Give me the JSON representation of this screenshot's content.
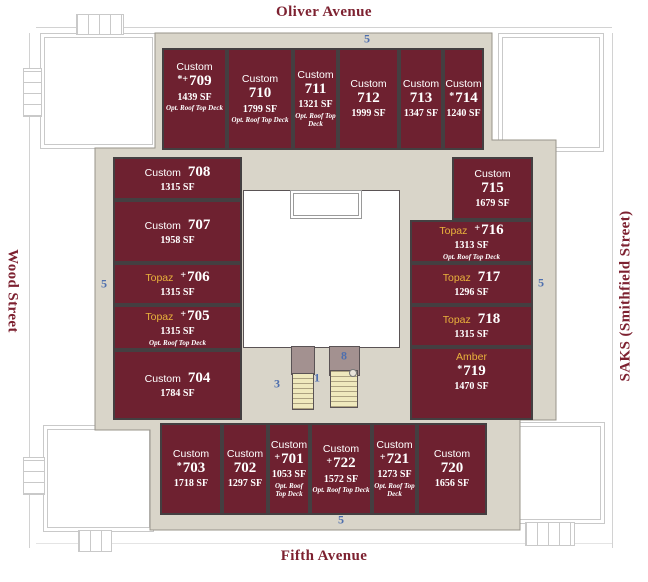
{
  "streets": {
    "top": "Oliver Avenue",
    "bottom": "Fifth Avenue",
    "left": "Wood Street",
    "right": "SAKS (Smithfield Street)"
  },
  "units": [
    {
      "id": "709",
      "brand": "Custom",
      "style": "custom",
      "prefix": "*+",
      "number": "709",
      "sf": "1439 SF",
      "note": "Opt. Roof Top Deck",
      "layout": "stacked"
    },
    {
      "id": "710",
      "brand": "Custom",
      "style": "custom",
      "prefix": "",
      "number": "710",
      "sf": "1799 SF",
      "note": "Opt. Roof Top Deck",
      "layout": "stacked"
    },
    {
      "id": "711",
      "brand": "Custom",
      "style": "custom",
      "prefix": "",
      "number": "711",
      "sf": "1321 SF",
      "note": "Opt. Roof Top Deck",
      "layout": "stacked"
    },
    {
      "id": "712",
      "brand": "Custom",
      "style": "custom",
      "prefix": "",
      "number": "712",
      "sf": "1999 SF",
      "note": "",
      "layout": "stacked"
    },
    {
      "id": "713",
      "brand": "Custom",
      "style": "custom",
      "prefix": "",
      "number": "713",
      "sf": "1347 SF",
      "note": "",
      "layout": "stacked"
    },
    {
      "id": "714",
      "brand": "Custom",
      "style": "custom",
      "prefix": "*",
      "number": "714",
      "sf": "1240 SF",
      "note": "",
      "layout": "stacked"
    },
    {
      "id": "708",
      "brand": "Custom",
      "style": "custom",
      "prefix": "",
      "number": "708",
      "sf": "1315 SF",
      "note": "",
      "layout": "inline"
    },
    {
      "id": "707",
      "brand": "Custom",
      "style": "custom",
      "prefix": "",
      "number": "707",
      "sf": "1958 SF",
      "note": "",
      "layout": "inline"
    },
    {
      "id": "706",
      "brand": "Topaz",
      "style": "topaz",
      "prefix": "+",
      "number": "706",
      "sf": "1315 SF",
      "note": "",
      "layout": "inline"
    },
    {
      "id": "705",
      "brand": "Topaz",
      "style": "topaz",
      "prefix": "+",
      "number": "705",
      "sf": "1315 SF",
      "note": "Opt. Roof Top Deck",
      "layout": "inline"
    },
    {
      "id": "704",
      "brand": "Custom",
      "style": "custom",
      "prefix": "",
      "number": "704",
      "sf": "1784 SF",
      "note": "",
      "layout": "inline"
    },
    {
      "id": "715",
      "brand": "Custom",
      "style": "custom",
      "prefix": "",
      "number": "715",
      "sf": "1679 SF",
      "note": "",
      "layout": "stacked"
    },
    {
      "id": "716",
      "brand": "Topaz",
      "style": "topaz",
      "prefix": "+",
      "number": "716",
      "sf": "1313 SF",
      "note": "Opt. Roof Top Deck",
      "layout": "inline"
    },
    {
      "id": "717",
      "brand": "Topaz",
      "style": "topaz",
      "prefix": "",
      "number": "717",
      "sf": "1296 SF",
      "note": "",
      "layout": "inline"
    },
    {
      "id": "718",
      "brand": "Topaz",
      "style": "topaz",
      "prefix": "",
      "number": "718",
      "sf": "1315 SF",
      "note": "",
      "layout": "inline"
    },
    {
      "id": "719",
      "brand": "Amber",
      "style": "amber",
      "prefix": "*",
      "number": "719",
      "sf": "1470 SF",
      "note": "",
      "layout": "stacked"
    },
    {
      "id": "703",
      "brand": "Custom",
      "style": "custom",
      "prefix": "*",
      "number": "703",
      "sf": "1718 SF",
      "note": "",
      "layout": "stacked"
    },
    {
      "id": "702",
      "brand": "Custom",
      "style": "custom",
      "prefix": "",
      "number": "702",
      "sf": "1297 SF",
      "note": "",
      "layout": "stacked"
    },
    {
      "id": "701",
      "brand": "Custom",
      "style": "custom",
      "prefix": "+",
      "number": "701",
      "sf": "1053 SF",
      "note": "Opt. Roof Top Deck",
      "layout": "stacked"
    },
    {
      "id": "722",
      "brand": "Custom",
      "style": "custom",
      "prefix": "+",
      "number": "722",
      "sf": "1572 SF",
      "note": "Opt. Roof Top Deck",
      "layout": "stacked"
    },
    {
      "id": "721",
      "brand": "Custom",
      "style": "custom",
      "prefix": "+",
      "number": "721",
      "sf": "1273 SF",
      "note": "Opt. Roof Top Deck",
      "layout": "stacked"
    },
    {
      "id": "720",
      "brand": "Custom",
      "style": "custom",
      "prefix": "",
      "number": "720",
      "sf": "1656 SF",
      "note": "",
      "layout": "stacked"
    }
  ],
  "markers": [
    {
      "id": "stair-top",
      "label": "5"
    },
    {
      "id": "stair-left",
      "label": "5"
    },
    {
      "id": "stair-right",
      "label": "5"
    },
    {
      "id": "stair-bottom",
      "label": "5"
    },
    {
      "id": "core-3",
      "label": "3"
    },
    {
      "id": "core-1",
      "label": "1"
    },
    {
      "id": "core-8",
      "label": "8"
    }
  ],
  "colors": {
    "unit_fill": "#6e2130",
    "wall": "#443f41",
    "walkway": "#d9d5c9",
    "stair_fill": "#efe9bd",
    "vestibule": "#a39190",
    "marker_blue": "#4e6fae",
    "street_label": "#7d2130",
    "brand_topaz": "#e9b23c"
  }
}
